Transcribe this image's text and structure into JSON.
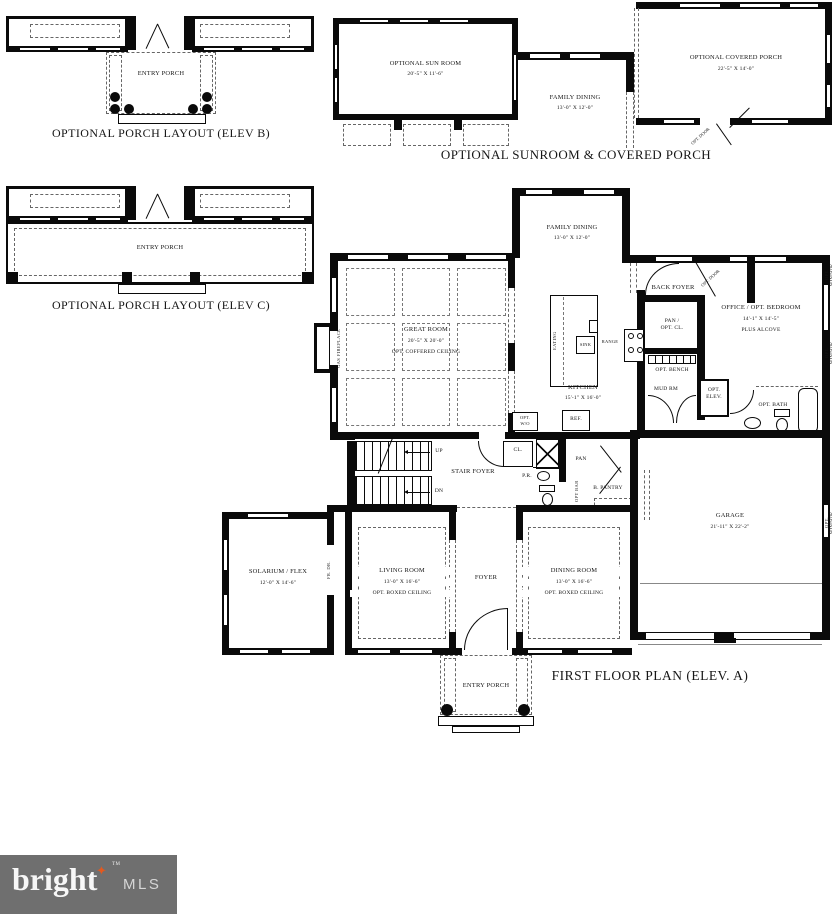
{
  "captions": {
    "porch_b": "OPTIONAL PORCH LAYOUT (ELEV B)",
    "porch_c": "OPTIONAL PORCH LAYOUT (ELEV C)",
    "sunroom": "OPTIONAL SUNROOM & COVERED PORCH",
    "main": "FIRST FLOOR PLAN (ELEV. A)"
  },
  "porch_b": {
    "entry_porch": "ENTRY PORCH"
  },
  "porch_c": {
    "entry_porch": "ENTRY PORCH"
  },
  "sunroom_diagram": {
    "sun_room_name": "OPTIONAL SUN ROOM",
    "sun_room_dims": "20'-5\" X 11'-6\"",
    "family_dining_name": "FAMILY DINING",
    "family_dining_dims": "13'-0\" X 12'-0\"",
    "covered_porch_name": "OPTIONAL COVERED PORCH",
    "covered_porch_dims": "22'-5\" X 14'-0\"",
    "opt_door": "OPT. DOOR"
  },
  "main_plan": {
    "family_dining_name": "FAMILY DINING",
    "family_dining_dims": "13'-0\" X 12'-0\"",
    "great_room_name": "GREAT ROOM",
    "great_room_dims": "20'-5\" X 20'-0\"",
    "great_room_note": "OPT. COFFERED CEILING",
    "gas_fireplace": "GAS FIREPLACE",
    "kitchen_name": "KITCHEN",
    "kitchen_dims": "15'-1\" X 16'-0\"",
    "eating": "EATING",
    "sink": "SINK",
    "range": "RANGE",
    "ref": "REF.",
    "opt_wall_oven": "OPT.\nW/O",
    "office_name": "OFFICE / OPT. BEDROOM",
    "office_dims": "14'-1\" X 14'-5\"",
    "office_note": "PLUS ALCOVE",
    "back_foyer": "BACK FOYER",
    "opt_door": "OPT. DOOR",
    "pan_opt_cl": "PAN /\nOPT. CL.",
    "opt_bench": "OPT. BENCH",
    "mud_rm": "MUD RM",
    "opt_elev": "OPT.\nELEV.",
    "opt_bath": "OPT. BATH",
    "opt_window": "OPT. WINDOW",
    "stair_foyer": "STAIR FOYER",
    "up": "UP",
    "dn": "DN",
    "cl": "CL.",
    "pr": "P.R.",
    "pan": "PAN",
    "b_pantry": "B. PANTRY",
    "opt_bar": "OPT BAR",
    "solarium_name": "SOLARIUM / FLEX",
    "solarium_dims": "12'-0\" X 14'-6\"",
    "fr_dr": "FR. DR.",
    "living_name": "LIVING ROOM",
    "living_dims": "13'-0\" X 16'-6\"",
    "living_note": "OPT. BOXED CEILING",
    "foyer": "FOYER",
    "dining_name": "DINING ROOM",
    "dining_dims": "13'-0\" X 16'-6\"",
    "dining_note": "OPT. BOXED CEILING",
    "garage_name": "GARAGE",
    "garage_dims": "21'-11\" X 22'-2\"",
    "entry_porch": "ENTRY PORCH"
  },
  "logo": {
    "brand": "bright",
    "star": "✦",
    "tm": "TM",
    "suffix": "MLS"
  },
  "colors": {
    "wall": "#0a0a0a",
    "dash": "#666666",
    "logo_bg": "#6f6f6f",
    "logo_star": "#e2591f"
  }
}
